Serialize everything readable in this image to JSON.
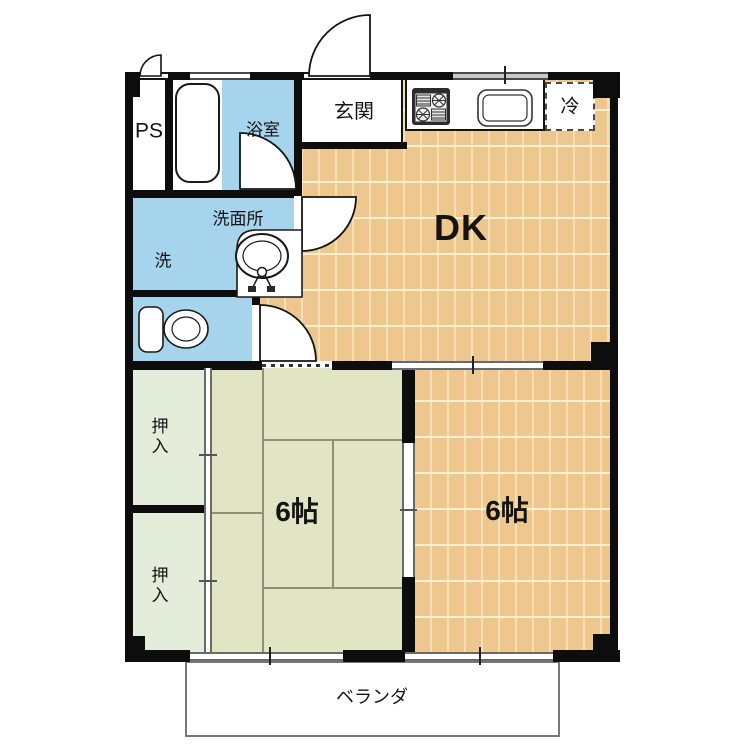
{
  "title": "2DK apartment floor plan",
  "colors": {
    "wall": "#0d0d0d",
    "wood": "#edc78d",
    "wood-line": "#f8e0b6",
    "tatami": "#e2e5c3",
    "closet": "#e4ecda",
    "water": "#a6d4ec"
  },
  "labels": {
    "ps": "PS",
    "bath": "浴室",
    "entrance": "玄関",
    "fridge": "冷",
    "washroom": "洗面所",
    "washer": "洗",
    "dk": "DK",
    "tatami_room": "6帖",
    "western_room": "6帖",
    "closet_upper": "押入",
    "closet_lower": "押入",
    "veranda": "ベランダ"
  },
  "icons": [
    "bathtub-icon",
    "toilet-icon",
    "washbasin-icon",
    "stove-icon",
    "kitchen-sink-icon",
    "door-swing-ps",
    "door-swing-entrance",
    "door-swing-bath",
    "door-swing-washroom",
    "door-swing-toilet"
  ]
}
